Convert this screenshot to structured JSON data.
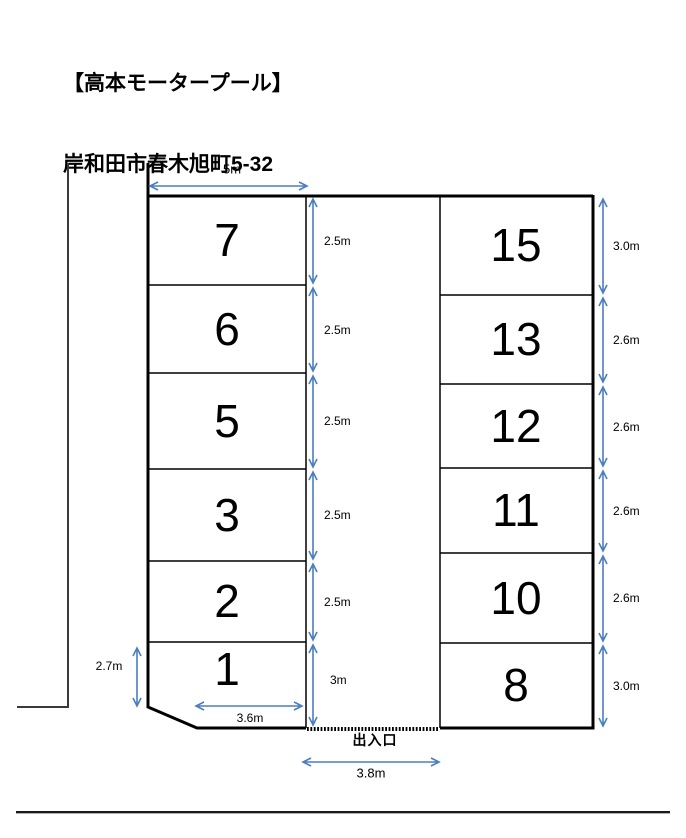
{
  "header": {
    "title": "【高本モータープール】",
    "address": "岸和田市春木旭町5-32"
  },
  "diagram": {
    "top_width_label": "5m",
    "left_side_label": "2.7m",
    "space1_width_label": "3.6m",
    "entrance_label": "出入口",
    "entrance_width_label": "3.8m",
    "left_column": [
      {
        "number": "7",
        "depth": "2.5m"
      },
      {
        "number": "6",
        "depth": "2.5m"
      },
      {
        "number": "5",
        "depth": "2.5m"
      },
      {
        "number": "3",
        "depth": "2.5m"
      },
      {
        "number": "2",
        "depth": "2.5m"
      },
      {
        "number": "1",
        "depth": "3m"
      }
    ],
    "right_column": [
      {
        "number": "15",
        "depth": "3.0m"
      },
      {
        "number": "13",
        "depth": "2.6m"
      },
      {
        "number": "12",
        "depth": "2.6m"
      },
      {
        "number": "11",
        "depth": "2.6m"
      },
      {
        "number": "10",
        "depth": "2.6m"
      },
      {
        "number": "8",
        "depth": "3.0m"
      }
    ]
  },
  "colors": {
    "dimension_arrow": "#4a7ebf",
    "outline": "#000000",
    "road_line": "#3a3a3a"
  }
}
